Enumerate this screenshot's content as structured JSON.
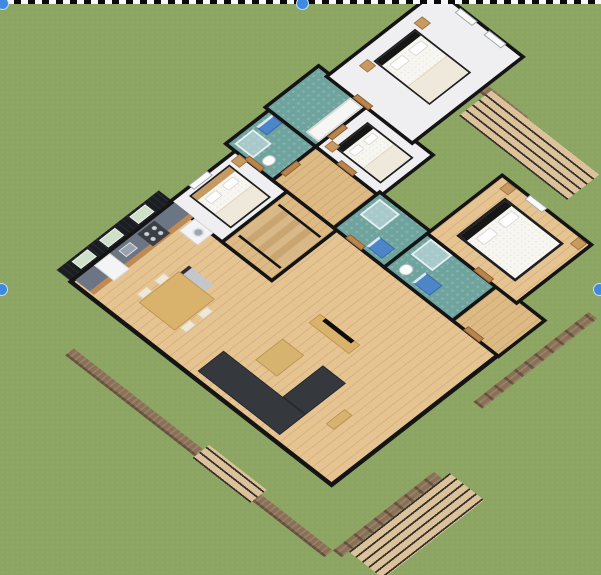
{
  "canvas": {
    "type": "3d-floor-plan-render",
    "background": "grass-lawn",
    "view": "aerial-dimetric-cutaway"
  },
  "selection": {
    "style": "dashed-marquee-top-edge",
    "handle_color": "#3F8AE0",
    "handles": [
      {
        "position": "top-left"
      },
      {
        "position": "top-center"
      },
      {
        "position": "middle-left"
      },
      {
        "position": "middle-right"
      }
    ]
  },
  "palette": {
    "grass": "#8CA562",
    "wall_black": "#141414",
    "wood_floor": "#E6C491",
    "white_floor": "#EFEFF2",
    "bathroom_teal": "#6FA39E",
    "stone_wall": "#8A7055",
    "deck_plank": "#DCC29A",
    "dark_siding": "#1A1D21",
    "counter_gray": "#6B7584",
    "cabinet_wood": "#C08B52",
    "sofa_charcoal": "#35393D",
    "vanity_blue": "#4C86C9",
    "bed_white": "#F7F6F0",
    "accent_wood": "#C79A62"
  },
  "rooms": [
    {
      "id": "living-room",
      "label": "Living / dining room",
      "floor": "wood",
      "furniture": [
        "sectional-sofa",
        "coffee-table",
        "tv-console",
        "tv",
        "dining-table",
        "dining-chairs",
        "bench",
        "column"
      ]
    },
    {
      "id": "kitchen",
      "label": "Kitchen",
      "floor": "wood",
      "furniture": [
        "counter-with-cabinets",
        "sink",
        "stove",
        "fridge",
        "washing-machine"
      ]
    },
    {
      "id": "stair-hall",
      "label": "Stair hall",
      "floor": "wood",
      "furniture": [
        "staircase"
      ]
    },
    {
      "id": "bedroom-1",
      "label": "Bedroom 1",
      "floor": "white",
      "furniture": [
        "bed",
        "nightstand"
      ],
      "features": [
        "window"
      ]
    },
    {
      "id": "bathroom-1",
      "label": "Bathroom 1",
      "floor": "teal",
      "furniture": [
        "shower",
        "blue-vanity",
        "toilet"
      ]
    },
    {
      "id": "hallway",
      "label": "Hallway",
      "floor": "wood",
      "furniture": []
    },
    {
      "id": "bathroom-2",
      "label": "Bathroom 2",
      "floor": "teal",
      "furniture": [
        "bathtub"
      ]
    },
    {
      "id": "bedroom-2",
      "label": "Bedroom 2",
      "floor": "white",
      "furniture": [
        "bed",
        "nightstand"
      ]
    },
    {
      "id": "bedroom-3",
      "label": "Bedroom 3",
      "floor": "white",
      "furniture": [
        "bed",
        "nightstand",
        "nightstand"
      ],
      "features": [
        "windows"
      ]
    },
    {
      "id": "bathroom-3",
      "label": "Bathroom 3",
      "floor": "teal",
      "furniture": [
        "shower",
        "blue-vanity"
      ]
    },
    {
      "id": "master-bathroom",
      "label": "Master bathroom",
      "floor": "teal",
      "furniture": [
        "toilet",
        "blue-vanity",
        "shower"
      ]
    },
    {
      "id": "master-hall",
      "label": "Master hall",
      "floor": "wood",
      "furniture": []
    },
    {
      "id": "master-bedroom",
      "label": "Master bedroom",
      "floor": "wood",
      "furniture": [
        "double-bed",
        "nightstand",
        "nightstand"
      ],
      "features": [
        "window"
      ]
    }
  ],
  "exterior": {
    "facade": "dark-siding-with-green-windows",
    "base_walls": "stone-texture",
    "decks": [
      {
        "id": "deck-east",
        "label": "East wood deck"
      },
      {
        "id": "deck-south",
        "label": "South wood deck"
      },
      {
        "id": "deck-west",
        "label": "West wood deck"
      }
    ],
    "siding_window_count": 3
  }
}
